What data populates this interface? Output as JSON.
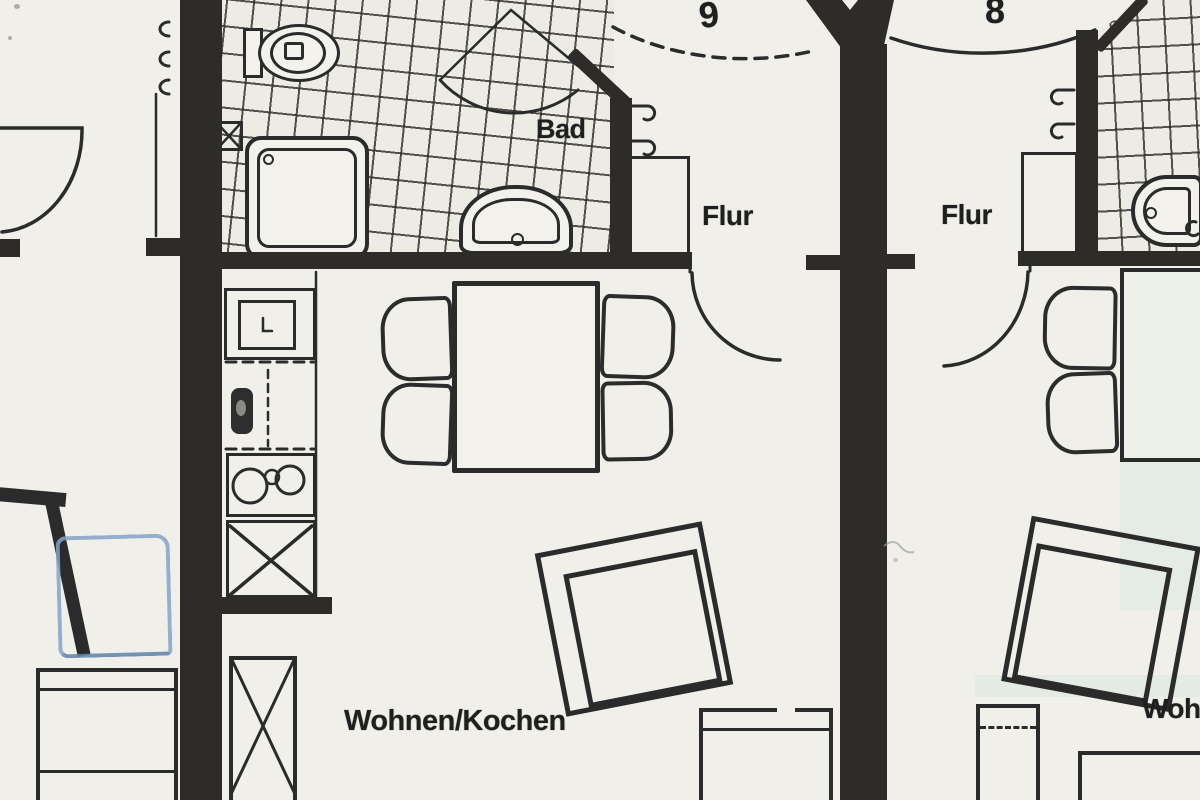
{
  "colors": {
    "paper": "#f0efea",
    "ink": "#262626",
    "wall": "#2e2c29",
    "blue_pen": "#84a3c9",
    "stain": "#d6d096",
    "tint": "#cde4da"
  },
  "apartments": {
    "center_number": "9",
    "right_number": "8"
  },
  "labels": {
    "bath": "Bad",
    "hall_center": "Flur",
    "hall_right": "Flur",
    "living_center": "Wohnen/Kochen",
    "living_right_partial": "Woh"
  }
}
